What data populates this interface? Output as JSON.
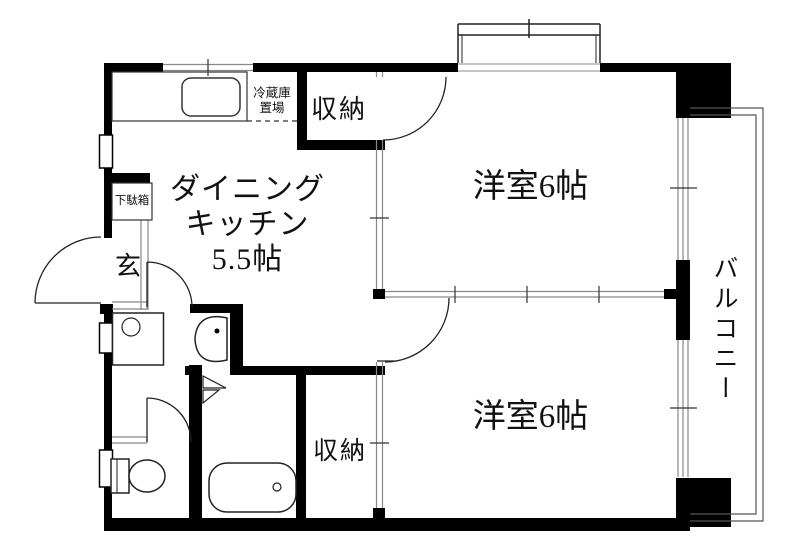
{
  "floorplan": {
    "title": "2DK apartment floor plan",
    "rooms": {
      "dining_kitchen": {
        "line1": "ダイニング",
        "line2": "キッチン",
        "line3": "5.5帖"
      },
      "western_room_top": {
        "label": "洋室6帖"
      },
      "western_room_bottom": {
        "label": "洋室6帖"
      },
      "balcony": {
        "label": "バルコニー"
      },
      "closet_top": {
        "label": "収納"
      },
      "closet_bottom": {
        "label": "収納"
      },
      "entrance": {
        "label": "玄"
      },
      "shoe_cabinet": {
        "label": "下駄箱"
      },
      "refrigerator_space": {
        "line1": "冷蔵庫",
        "line2": "置場"
      }
    },
    "fixtures": [
      "kitchen-sink",
      "washing-machine",
      "washbasin",
      "toilet",
      "bathtub",
      "folding-door",
      "hinged-doors",
      "sliding-partitions",
      "bay-window",
      "balcony-railing"
    ],
    "colors": {
      "wall": "#000000",
      "door_line": "#222222",
      "window_line": "#888888",
      "railing_line": "#555555",
      "background": "#ffffff"
    }
  }
}
